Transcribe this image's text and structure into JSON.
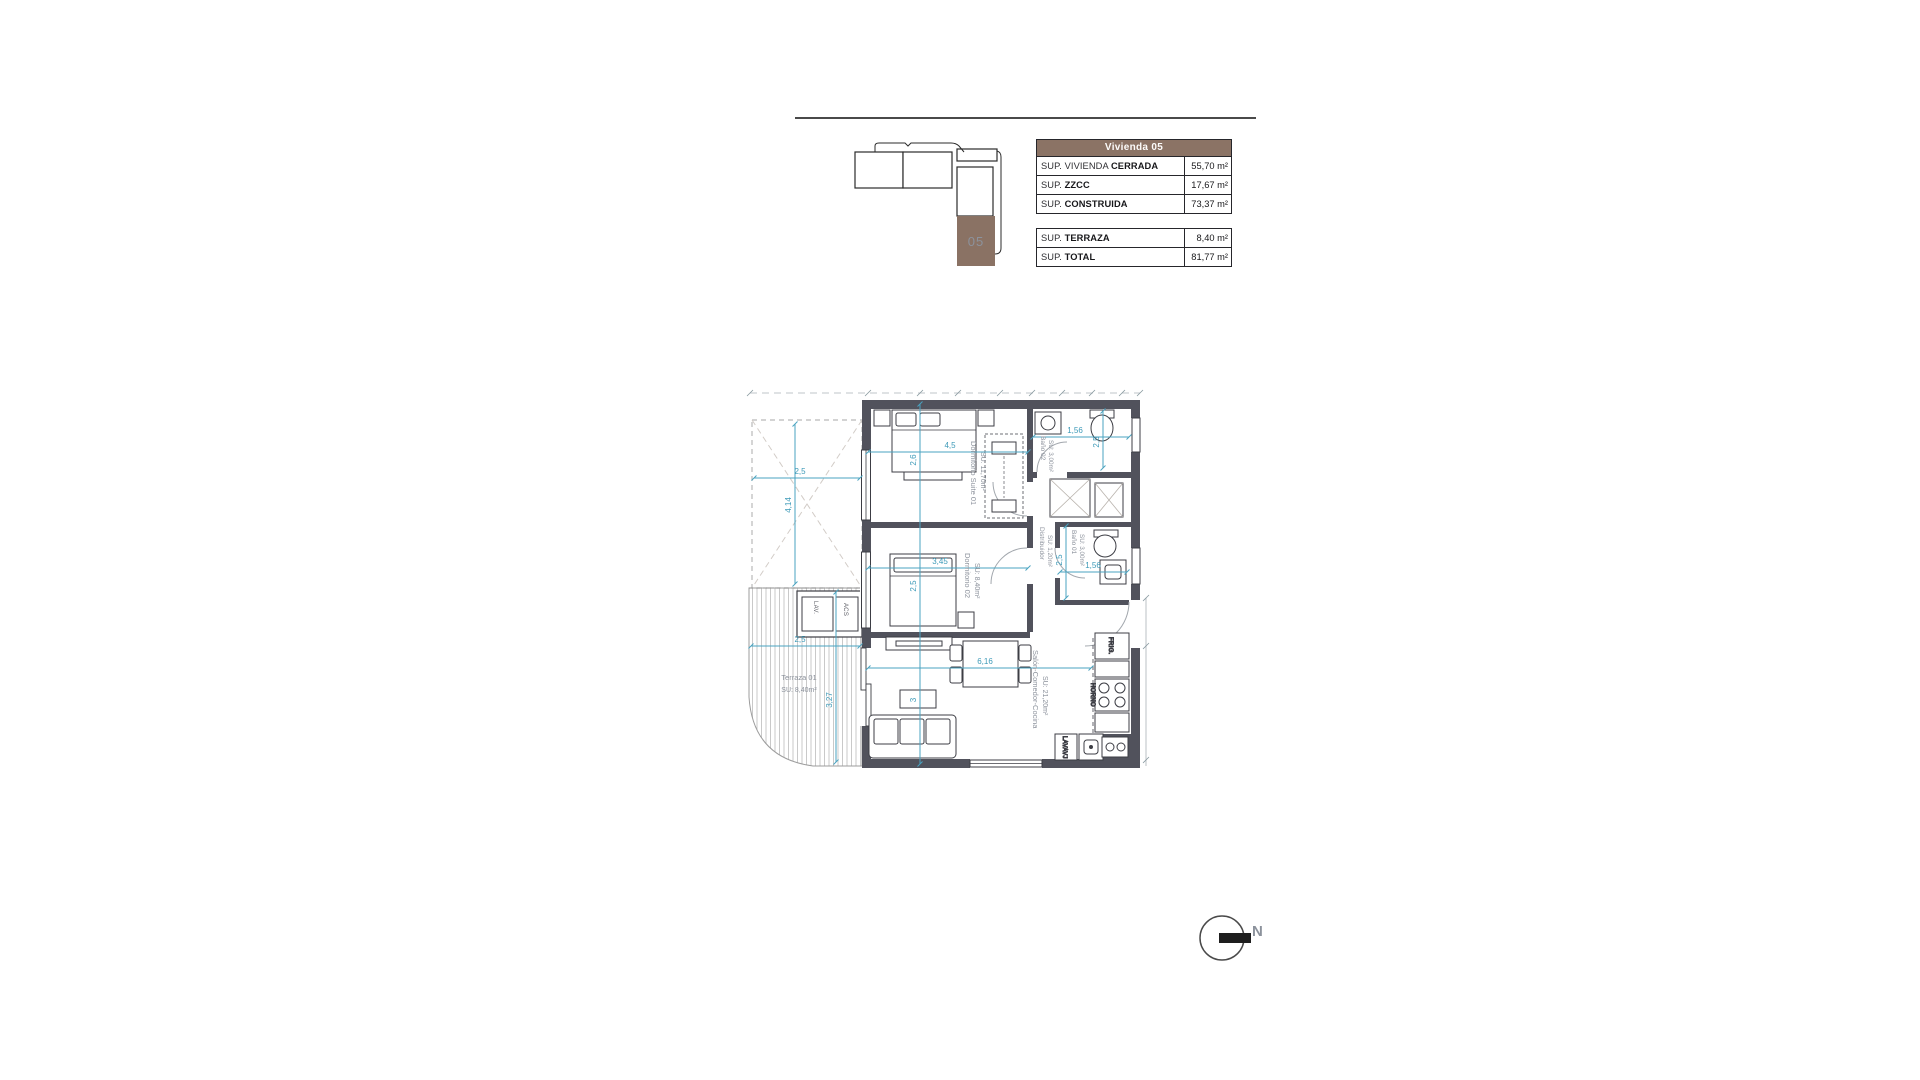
{
  "key_plan": {
    "unit_label": "05",
    "highlight_color": "#8a7264"
  },
  "tables": {
    "main": {
      "header": "Vivienda 05",
      "rows": [
        {
          "pre": "SUP. VIVIENDA ",
          "bold": "CERRADA",
          "value": "55,70 m²"
        },
        {
          "pre": "SUP. ",
          "bold": "ZZCC",
          "value": "17,67 m²"
        },
        {
          "pre": "SUP. ",
          "bold": "CONSTRUIDA",
          "value": "73,37 m²"
        }
      ]
    },
    "secondary": {
      "rows": [
        {
          "pre": "SUP. ",
          "bold": "TERRAZA",
          "value": "8,40 m²"
        },
        {
          "pre": "SUP. ",
          "bold": "TOTAL",
          "value": "81,77 m²"
        }
      ]
    }
  },
  "plan": {
    "rooms": {
      "suite": {
        "name": "Dormitorio Suite 01",
        "area": "SU: 11,70m²"
      },
      "bano2": {
        "name": "Baño 02",
        "area": "SU: 3,00m²"
      },
      "distribuidor": {
        "name": "Distribuidor",
        "area": "SU: 1,20m²"
      },
      "dorm2": {
        "name": "Dormitorio 02",
        "area": "SU: 8,40m²"
      },
      "bano1": {
        "name": "Baño 01",
        "area": "SU: 3,00m²"
      },
      "salon": {
        "name": "Salón-Comedor-Cocina",
        "area": "SU: 21,20m²"
      },
      "terraza": {
        "name": "Terraza 01",
        "area": "SU: 8,40m²"
      }
    },
    "dims": {
      "pergola_w": "2,5",
      "pergola_h": "4,14",
      "suite_w": "4,5",
      "suite_h": "2,6",
      "bano2_w": "1,56",
      "bano2_h": "2,5",
      "dorm2_w": "3,45",
      "dorm2_h": "2,5",
      "bano1_w": "1,56",
      "bano1_h": "2,5",
      "salon_w": "6,16",
      "salon_h": "3",
      "terraza_w": "2,5",
      "terraza_h": "3,27"
    },
    "appliances": {
      "lav": "LAV.",
      "acs": "ACS",
      "frig": "FRIG.",
      "horno": "HORNO",
      "lavavajillas": "LAVAVJ"
    }
  },
  "north_label": "N",
  "colors": {
    "wall": "#51525c",
    "dimension": "#4aa3c0",
    "room_label": "#8c929c",
    "brand_brown": "#8b7365"
  }
}
